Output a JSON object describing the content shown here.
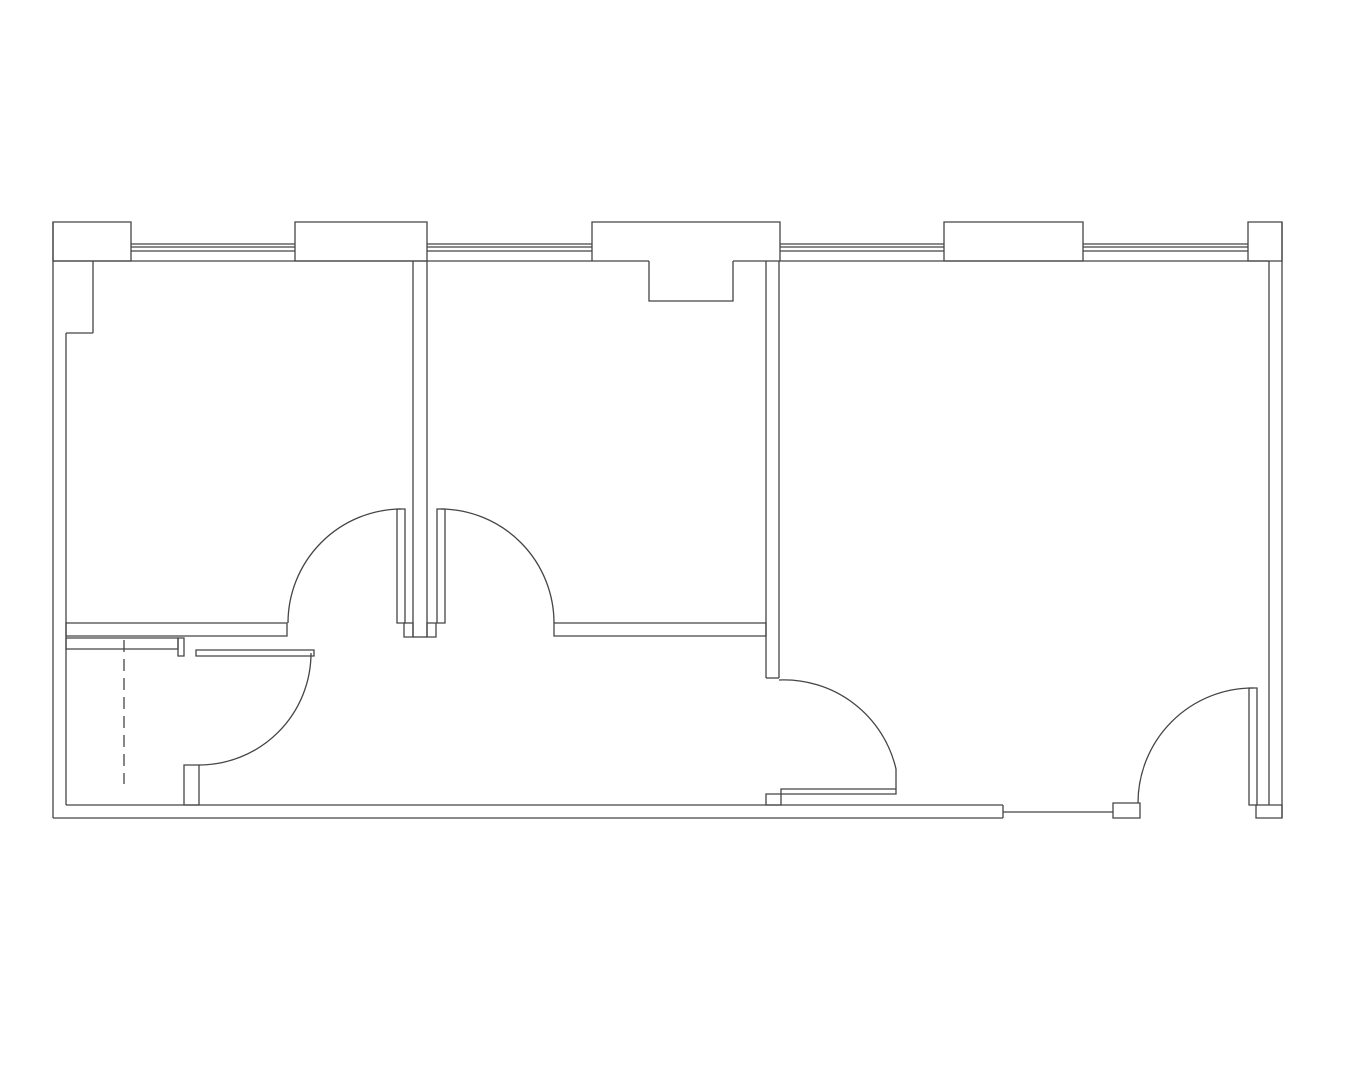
{
  "page": {
    "background": "#ffffff",
    "line_color": "#454545",
    "line_width": 1.3
  },
  "floor_plan": {
    "canvas": {
      "width": 1350,
      "height": 1080
    },
    "groups": [
      {
        "name": "exterior-shell",
        "primitives": [
          {
            "n": "wall-left-outer",
            "t": "line",
            "x1": 53,
            "y1": 222,
            "x2": 53,
            "y2": 818
          },
          {
            "n": "wall-right-outer",
            "t": "line",
            "x1": 1282,
            "y1": 222,
            "x2": 1282,
            "y2": 818
          },
          {
            "n": "wall-top-inner-west",
            "t": "line",
            "x1": 53,
            "y1": 261,
            "x2": 649,
            "y2": 261
          },
          {
            "n": "wall-top-inner-east",
            "t": "line",
            "x1": 733,
            "y1": 261,
            "x2": 1269,
            "y2": 261
          },
          {
            "n": "wall-left-inner-upper",
            "t": "line",
            "x1": 93,
            "y1": 261,
            "x2": 93,
            "y2": 333
          },
          {
            "n": "wall-left-inner-step",
            "t": "line",
            "x1": 66,
            "y1": 333,
            "x2": 93,
            "y2": 333
          },
          {
            "n": "wall-left-inner-lower",
            "t": "line",
            "x1": 66,
            "y1": 333,
            "x2": 66,
            "y2": 805
          },
          {
            "n": "wall-right-inner",
            "t": "line",
            "x1": 1269,
            "y1": 261,
            "x2": 1269,
            "y2": 805
          },
          {
            "n": "wall-bottom-inner",
            "t": "line",
            "x1": 66,
            "y1": 805,
            "x2": 1003,
            "y2": 805
          },
          {
            "n": "wall-bottom-outer",
            "t": "line",
            "x1": 53,
            "y1": 818,
            "x2": 1003,
            "y2": 818
          },
          {
            "n": "wall-bottom-end-cap",
            "t": "line",
            "x1": 1003,
            "y1": 805,
            "x2": 1003,
            "y2": 818
          }
        ]
      },
      {
        "name": "top-piers",
        "primitives": [
          {
            "n": "pier-1",
            "t": "rect",
            "x": 53,
            "y": 222,
            "w": 78,
            "h": 39
          },
          {
            "n": "pier-2",
            "t": "rect",
            "x": 295,
            "y": 222,
            "w": 132,
            "h": 39
          },
          {
            "n": "pier-3-notched",
            "t": "path",
            "d": "M 592 261 L 592 222 L 780 222 L 780 261 M 649 261 L 649 301 L 733 301 L 733 261"
          },
          {
            "n": "pier-4",
            "t": "rect",
            "x": 944,
            "y": 222,
            "w": 139,
            "h": 39
          },
          {
            "n": "pier-5",
            "t": "rect",
            "x": 1248,
            "y": 222,
            "w": 34,
            "h": 39
          }
        ]
      },
      {
        "name": "windows",
        "primitives": [
          {
            "n": "window-1-line-outer",
            "t": "line",
            "x1": 131,
            "y1": 244,
            "x2": 295,
            "y2": 244
          },
          {
            "n": "window-1-line-mid",
            "t": "line",
            "x1": 131,
            "y1": 247,
            "x2": 295,
            "y2": 247
          },
          {
            "n": "window-1-line-inner",
            "t": "line",
            "x1": 131,
            "y1": 251,
            "x2": 295,
            "y2": 251
          },
          {
            "n": "window-2-line-outer",
            "t": "line",
            "x1": 427,
            "y1": 244,
            "x2": 592,
            "y2": 244
          },
          {
            "n": "window-2-line-mid",
            "t": "line",
            "x1": 427,
            "y1": 247,
            "x2": 592,
            "y2": 247
          },
          {
            "n": "window-2-line-inner",
            "t": "line",
            "x1": 427,
            "y1": 251,
            "x2": 592,
            "y2": 251
          },
          {
            "n": "window-3-line-outer",
            "t": "line",
            "x1": 780,
            "y1": 244,
            "x2": 944,
            "y2": 244
          },
          {
            "n": "window-3-line-mid",
            "t": "line",
            "x1": 780,
            "y1": 247,
            "x2": 944,
            "y2": 247
          },
          {
            "n": "window-3-line-inner",
            "t": "line",
            "x1": 780,
            "y1": 251,
            "x2": 944,
            "y2": 251
          },
          {
            "n": "window-4-line-outer",
            "t": "line",
            "x1": 1083,
            "y1": 244,
            "x2": 1248,
            "y2": 244
          },
          {
            "n": "window-4-line-mid",
            "t": "line",
            "x1": 1083,
            "y1": 247,
            "x2": 1248,
            "y2": 247
          },
          {
            "n": "window-4-line-inner",
            "t": "line",
            "x1": 1083,
            "y1": 251,
            "x2": 1248,
            "y2": 251
          }
        ]
      },
      {
        "name": "interior-partitions",
        "primitives": [
          {
            "n": "partition-1-west-line",
            "t": "line",
            "x1": 413,
            "y1": 261,
            "x2": 413,
            "y2": 637
          },
          {
            "n": "partition-1-east-line",
            "t": "line",
            "x1": 427,
            "y1": 261,
            "x2": 427,
            "y2": 637
          },
          {
            "n": "partition-1-end-cap",
            "t": "line",
            "x1": 413,
            "y1": 637,
            "x2": 427,
            "y2": 637
          },
          {
            "n": "partition-2-west-line",
            "t": "line",
            "x1": 766,
            "y1": 261,
            "x2": 766,
            "y2": 678
          },
          {
            "n": "partition-2-east-line",
            "t": "line",
            "x1": 779,
            "y1": 261,
            "x2": 779,
            "y2": 678
          },
          {
            "n": "partition-2-end-cap",
            "t": "line",
            "x1": 766,
            "y1": 678,
            "x2": 779,
            "y2": 678
          },
          {
            "n": "hall-wall-west",
            "t": "rect",
            "x": 66,
            "y": 623,
            "w": 221,
            "h": 13
          },
          {
            "n": "hall-wall-east",
            "t": "rect",
            "x": 554,
            "y": 623,
            "w": 212,
            "h": 13
          },
          {
            "n": "door-1-jamb",
            "t": "rect",
            "x": 404,
            "y": 623,
            "w": 9,
            "h": 14
          },
          {
            "n": "door-2-jamb",
            "t": "rect",
            "x": 427,
            "y": 623,
            "w": 9,
            "h": 14
          }
        ]
      },
      {
        "name": "doors",
        "primitives": [
          {
            "n": "door-1-leaf",
            "t": "rect",
            "x": 397,
            "y": 509,
            "w": 8,
            "h": 114
          },
          {
            "n": "door-1-swing-arc",
            "t": "path",
            "d": "M 288 623 A 114 114 0 0 1 401 509"
          },
          {
            "n": "door-2-leaf",
            "t": "rect",
            "x": 437,
            "y": 509,
            "w": 8,
            "h": 114
          },
          {
            "n": "door-2-swing-arc",
            "t": "path",
            "d": "M 441 509 A 114 114 0 0 1 554 623"
          },
          {
            "n": "door-3-leaf",
            "t": "rect",
            "x": 781,
            "y": 789,
            "w": 115,
            "h": 5
          },
          {
            "n": "door-3-swing-arc",
            "t": "path",
            "d": "M 779 680 A 115 115 0 0 1 896 769 L 896 789"
          },
          {
            "n": "door-3-jamb",
            "t": "rect",
            "x": 766,
            "y": 794,
            "w": 15,
            "h": 11
          },
          {
            "n": "entry-threshold",
            "t": "line",
            "x1": 1003,
            "y1": 812,
            "x2": 1113,
            "y2": 812
          },
          {
            "n": "entry-jamb-west",
            "t": "rect",
            "x": 1113,
            "y": 803,
            "w": 27,
            "h": 15
          },
          {
            "n": "entry-door-leaf",
            "t": "rect",
            "x": 1249,
            "y": 688,
            "w": 8,
            "h": 117
          },
          {
            "n": "entry-swing-arc",
            "t": "path",
            "d": "M 1138 803 A 115 115 0 0 1 1253 688"
          },
          {
            "n": "entry-corner-jamb",
            "t": "rect",
            "x": 1256,
            "y": 805,
            "w": 26,
            "h": 13
          }
        ]
      },
      {
        "name": "bathroom",
        "primitives": [
          {
            "n": "bath-wall-top",
            "t": "rect",
            "x": 66,
            "y": 638,
            "w": 112,
            "h": 11
          },
          {
            "n": "bath-door-jamb",
            "t": "rect",
            "x": 178,
            "y": 638,
            "w": 6,
            "h": 18
          },
          {
            "n": "bath-door-leaf",
            "t": "rect",
            "x": 196,
            "y": 650,
            "w": 118,
            "h": 6
          },
          {
            "n": "bath-door-swing-arc",
            "t": "path",
            "d": "M 311 653 A 112 112 0 0 1 199 765"
          },
          {
            "n": "bath-wall-stub",
            "t": "rect",
            "x": 184,
            "y": 765,
            "w": 15,
            "h": 40
          },
          {
            "n": "bath-dashed-line",
            "t": "line",
            "x1": 124,
            "y1": 640,
            "x2": 124,
            "y2": 784,
            "dash": "12 7"
          }
        ]
      }
    ]
  }
}
